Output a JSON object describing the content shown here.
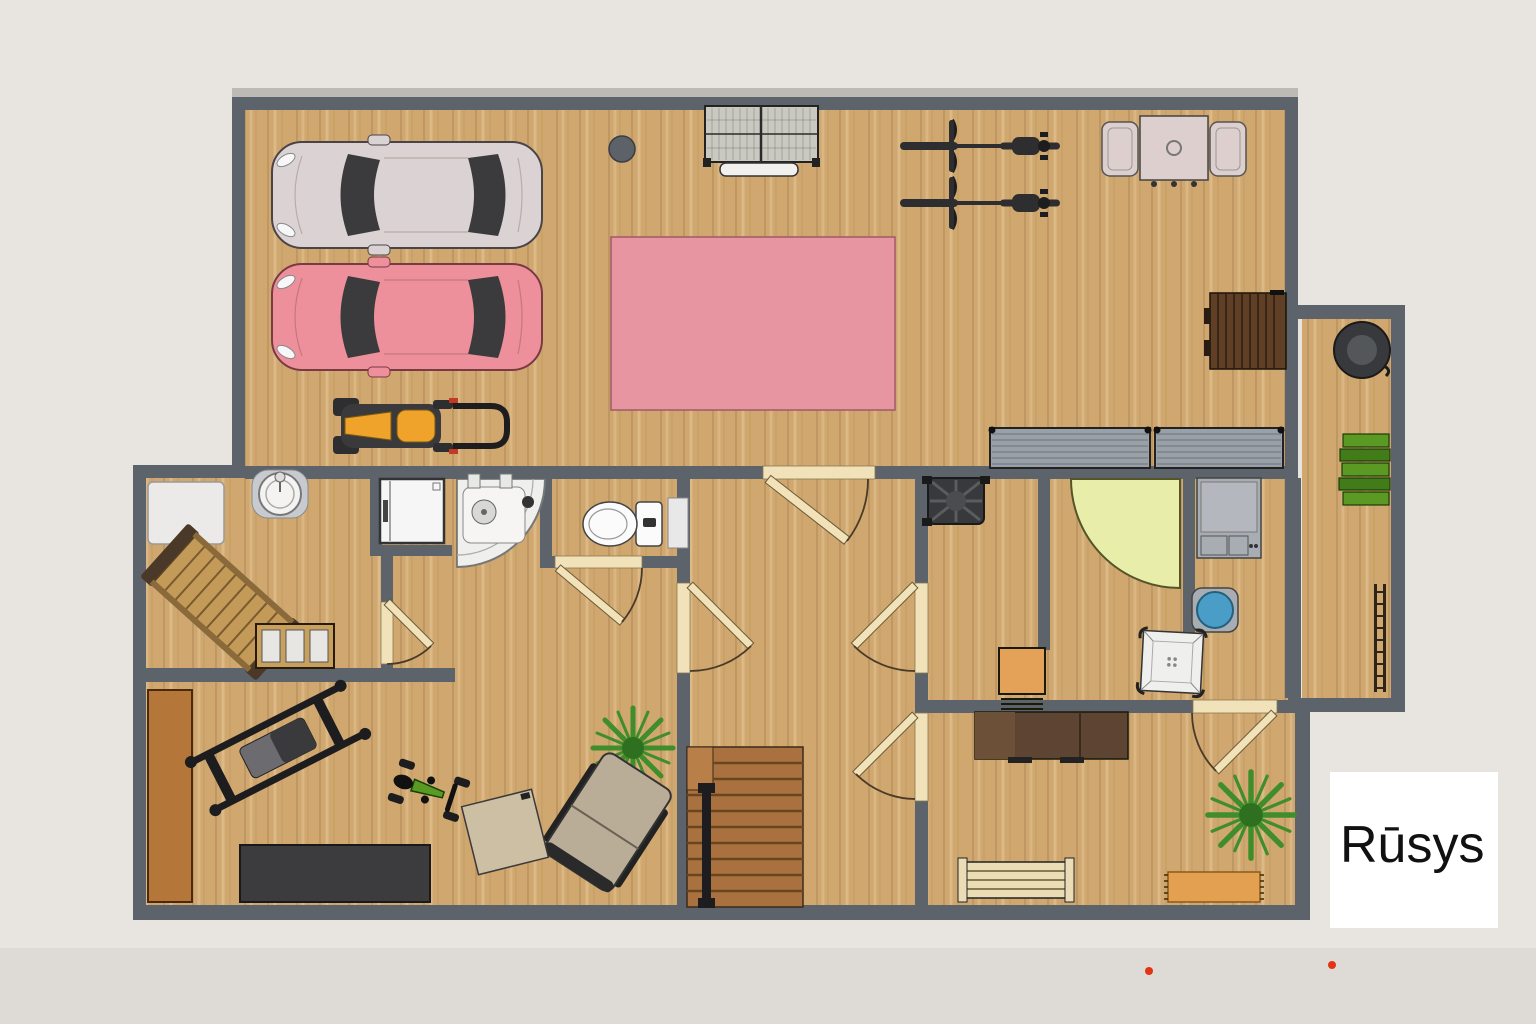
{
  "label": {
    "text": "Rūsys"
  },
  "palette": {
    "bg": "#e8e4df",
    "bgStrip": "#d5d1cc",
    "wall": "#5c636b",
    "wallCap": "#bdbab6",
    "doorLeaf": "#f2e2ba",
    "floor": "#cfa76f",
    "carWhite": "#dbd3d3",
    "carPink": "#ee8f9c",
    "carGlass": "#3b3b3d",
    "rugPink": "#e795a1",
    "meshTable": "#c9c9c1",
    "benchWhite": "#f2f0ec",
    "bucketGray": "#5d6268",
    "bikeDark": "#2e2e30",
    "tableTop": "#dccfcd",
    "stairDark": "#5f4026",
    "grayTable": "#9aa0a8",
    "stoveDark": "#38393c",
    "stoveInner": "#54575a",
    "green1": "#5a9a24",
    "green2": "#417c18",
    "ladderDark": "#2e2418",
    "counterWhite": "#eceae8",
    "sinkGray": "#c7cbd0",
    "white": "#f4f3f1",
    "loungerWood": "#c49a58",
    "loungerDark": "#4a3828",
    "benchWood": "#c8a05e",
    "cushionWhite": "#e8e6e2",
    "washerWhite": "#f6f6f6",
    "trayWhite": "#efefee",
    "toiletWhite": "#fbfbfb",
    "tubYellow": "#e9edaa",
    "applianceGray": "#a8adb4",
    "basinBlue": "#4a9dc7",
    "chairOrange": "#e3a257",
    "deskBrown": "#5d4433",
    "deskBrown2": "#6d5038",
    "benchCream": "#eadcb6",
    "rugOrange": "#e2a050",
    "plantGreen": "#3f8d2b",
    "plantCore": "#2f7020",
    "matDark": "#3c3c3e",
    "cabinetBrown": "#b5763a",
    "stairMain": "#a9713f",
    "stairLand": "#b87f48",
    "railBlack": "#1d1d1f",
    "bikeGreen": "#5a9a22",
    "mowerYellow": "#f0a32a",
    "mowerDark": "#3a3a3c",
    "labelBg": "#ffffff",
    "labelText": "#111111",
    "redDot": "#e23312"
  },
  "objects": [
    {
      "name": "car-white",
      "room": "garage"
    },
    {
      "name": "car-pink",
      "room": "garage"
    },
    {
      "name": "riding-mower",
      "room": "garage"
    },
    {
      "name": "mesh-workbench-table",
      "room": "garage"
    },
    {
      "name": "small-white-bench",
      "room": "garage"
    },
    {
      "name": "round-bucket",
      "room": "garage"
    },
    {
      "name": "pink-rug",
      "room": "garage"
    },
    {
      "name": "bicycle",
      "room": "garage",
      "count": 2
    },
    {
      "name": "dining-table-with-two-chairs",
      "room": "garage"
    },
    {
      "name": "dark-wood-staircase",
      "room": "garage"
    },
    {
      "name": "gray-folding-table",
      "room": "garage",
      "count": 2
    },
    {
      "name": "round-stove",
      "room": "annex"
    },
    {
      "name": "green-stacked-chairs",
      "room": "annex"
    },
    {
      "name": "ladder",
      "room": "annex"
    },
    {
      "name": "white-counter",
      "room": "lounge"
    },
    {
      "name": "round-sink",
      "room": "lounge"
    },
    {
      "name": "wooden-lounger",
      "room": "lounge"
    },
    {
      "name": "cushion-bench",
      "room": "lounge"
    },
    {
      "name": "washing-machine",
      "room": "utility-nook"
    },
    {
      "name": "corner-shower",
      "room": "shower-room"
    },
    {
      "name": "toilet",
      "room": "wc"
    },
    {
      "name": "potted-plant",
      "room": "family-area",
      "count": 2
    },
    {
      "name": "recliner-chair",
      "room": "family-area"
    },
    {
      "name": "beige-floor-mat",
      "room": "family-area"
    },
    {
      "name": "brown-wardrobe",
      "room": "gym"
    },
    {
      "name": "weight-bench",
      "room": "gym"
    },
    {
      "name": "exercise-bike",
      "room": "gym"
    },
    {
      "name": "dark-exercise-mat",
      "room": "gym"
    },
    {
      "name": "main-staircase-with-rail",
      "room": "stair-hall"
    },
    {
      "name": "sauna-stove-fan",
      "room": "sauna-area"
    },
    {
      "name": "yellow-corner-tub",
      "room": "sauna-area"
    },
    {
      "name": "gray-appliance",
      "room": "bathroom"
    },
    {
      "name": "blue-wash-basin",
      "room": "bathroom"
    },
    {
      "name": "square-shower-tray",
      "room": "bathroom"
    },
    {
      "name": "orange-chair",
      "room": "sauna-area"
    },
    {
      "name": "brown-sideboard",
      "room": "rec-room"
    },
    {
      "name": "slat-bench",
      "room": "rec-room"
    },
    {
      "name": "orange-rug",
      "room": "rec-room"
    },
    {
      "name": "floor-label-card",
      "room": "overlay"
    },
    {
      "name": "red-marker-dot",
      "room": "overlay",
      "count": 2
    }
  ]
}
